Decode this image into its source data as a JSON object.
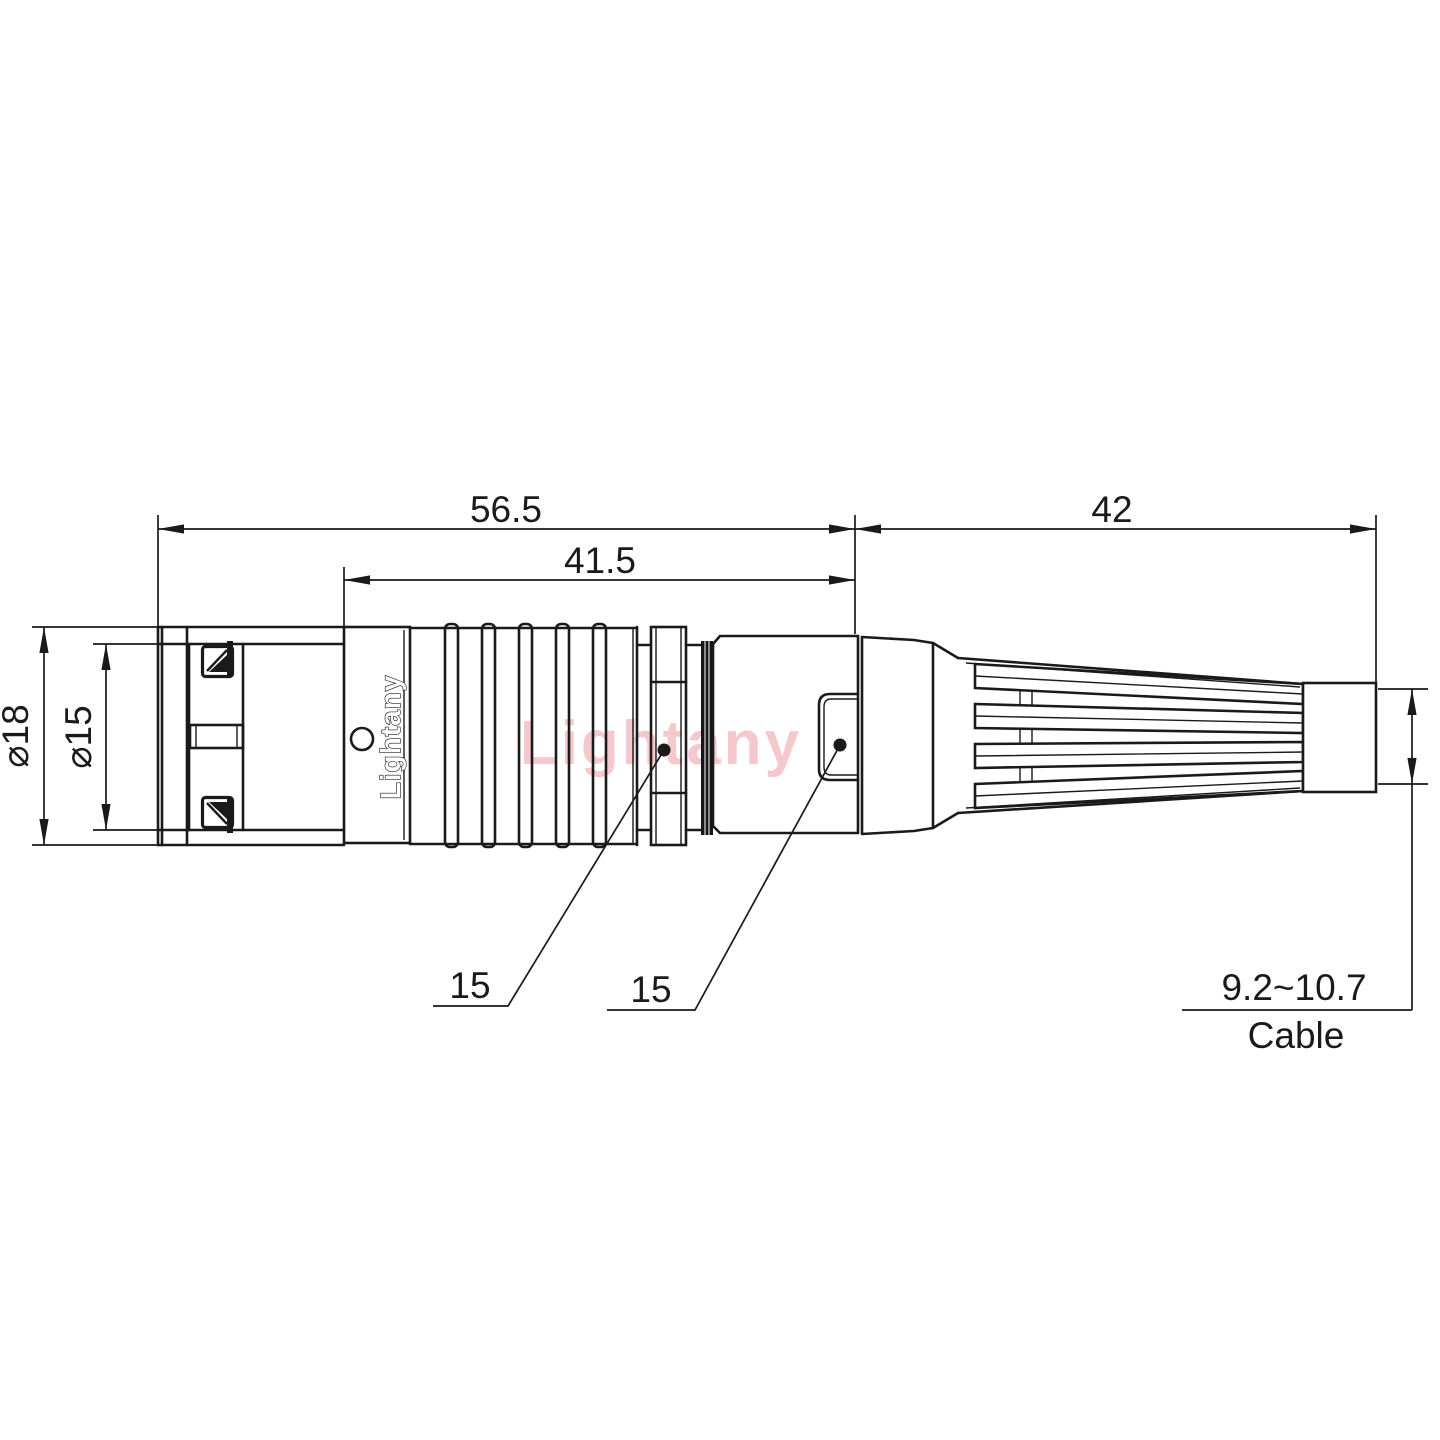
{
  "drawing": {
    "dimensions": {
      "total_length": "56.5",
      "front_length": "41.5",
      "boot_length": "42",
      "outer_diameter": "⌀18",
      "inner_diameter": "⌀15",
      "nut_flat": "15",
      "body_flat": "15",
      "cable_range": "9.2~10.7",
      "cable_label": "Cable"
    },
    "branding": {
      "engraving": "Lightany",
      "watermark": "Lightany"
    },
    "colors": {
      "line": "#1a1a1a",
      "watermark": "#f5c8cc",
      "background": "#ffffff"
    }
  }
}
